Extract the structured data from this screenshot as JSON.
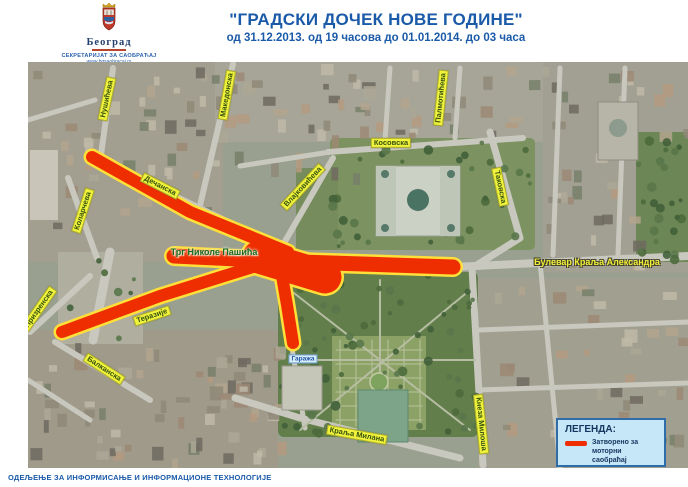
{
  "header": {
    "logo": {
      "city": "Београд",
      "org": "СЕКРЕТАРИЈАТ ЗА САОБРАЋАЈ",
      "url": "www.bgsaobracaj.rs"
    },
    "title": "\"ГРАДСКИ ДОЧЕК НОВЕ ГОДИНЕ\"",
    "subtitle": "од 31.12.2013. од 19 часова до 01.01.2014. до 03 часа"
  },
  "map": {
    "closed_color": "#ee2e00",
    "outline_color": "#ffdf3a",
    "route": {
      "segments": [
        {
          "pts": [
            [
              92,
              157
            ],
            [
              190,
              212
            ],
            [
              288,
              252
            ]
          ],
          "w": 12
        },
        {
          "pts": [
            [
              62,
              332
            ],
            [
              160,
              296
            ],
            [
              256,
              266
            ]
          ],
          "w": 12
        },
        {
          "pts": [
            [
              281,
              270
            ],
            [
              287,
              305
            ],
            [
              293,
              343
            ]
          ],
          "w": 12
        },
        {
          "pts": [
            [
              174,
              256
            ],
            [
              300,
              262
            ],
            [
              453,
              267
            ]
          ],
          "w": 15
        },
        {
          "pts": [
            [
              259,
              257
            ],
            [
              325,
              277
            ]
          ],
          "w": 33
        }
      ]
    },
    "labels": [
      {
        "text": "Нушићева",
        "x": 107,
        "y": 99,
        "rot": -78,
        "type": "box"
      },
      {
        "text": "Македонска",
        "x": 227,
        "y": 95,
        "rot": -80,
        "type": "box"
      },
      {
        "text": "Палмотићева",
        "x": 441,
        "y": 98,
        "rot": -84,
        "type": "box"
      },
      {
        "text": "Дечанска",
        "x": 160,
        "y": 186,
        "rot": 27,
        "type": "box"
      },
      {
        "text": "Коларчева",
        "x": 83,
        "y": 211,
        "rot": -72,
        "type": "box"
      },
      {
        "text": "Влајковићева",
        "x": 303,
        "y": 187,
        "rot": -47,
        "type": "box"
      },
      {
        "text": "Косовска",
        "x": 391,
        "y": 143,
        "rot": 0,
        "type": "box"
      },
      {
        "text": "Таковска",
        "x": 500,
        "y": 187,
        "rot": 78,
        "type": "box"
      },
      {
        "text": "Трг Николе Пашића",
        "x": 214,
        "y": 253,
        "rot": 0,
        "type": "green"
      },
      {
        "text": "Булевар Краља Александра",
        "x": 597,
        "y": 263,
        "rot": 0,
        "type": "yellow"
      },
      {
        "text": "Теразије",
        "x": 152,
        "y": 316,
        "rot": -18,
        "type": "box"
      },
      {
        "text": "Призренска",
        "x": 39,
        "y": 309,
        "rot": -55,
        "type": "box"
      },
      {
        "text": "Балканска",
        "x": 104,
        "y": 369,
        "rot": 33,
        "type": "box"
      },
      {
        "text": "Краља Милана",
        "x": 357,
        "y": 435,
        "rot": 10,
        "type": "box"
      },
      {
        "text": "Кнеза Милоша",
        "x": 481,
        "y": 424,
        "rot": 84,
        "type": "box"
      },
      {
        "text": "Гаража",
        "x": 303,
        "y": 359,
        "rot": 0,
        "type": "blue"
      }
    ]
  },
  "legend": {
    "title": "ЛЕГЕНДА:",
    "items": [
      {
        "symbol": "red-line",
        "label": "Затворено за моторни саобраћај"
      }
    ]
  },
  "footer": {
    "department": "ОДЕЉЕЊЕ ЗА ИНФОРМИСАЊЕ И ИНФОРМАЦИОНЕ ТЕХНОЛОГИЈЕ"
  }
}
